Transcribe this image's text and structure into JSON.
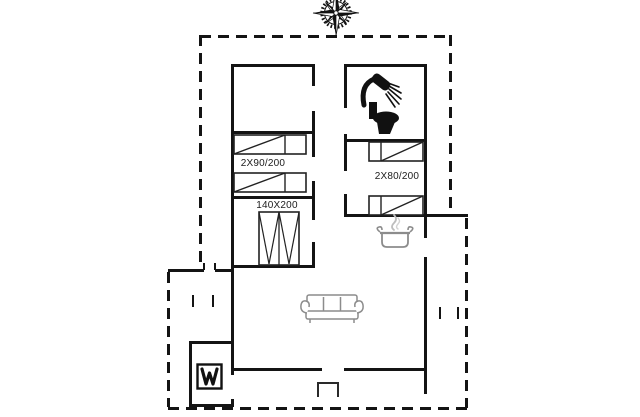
{
  "drawing": {
    "type": "holiday-house floor plan",
    "labels": {
      "bed_left": "2X90/200",
      "wardrobe": "140X200",
      "bed_right": "2X80/200"
    },
    "icons": {
      "compass": "compass-rose-icon",
      "shower": "shower-icon",
      "toilet": "toilet-icon",
      "pot": "cooking-pot-icon",
      "sofa": "sofa-icon",
      "fireplace": "wood-stove-icon",
      "bed": "bed-icon",
      "wardrobe": "wardrobe-icon"
    },
    "colors": {
      "wall": "#141414",
      "furniture_gray": "#8c8c8c",
      "text": "#1c1c1c",
      "background": "#ffffff"
    }
  }
}
